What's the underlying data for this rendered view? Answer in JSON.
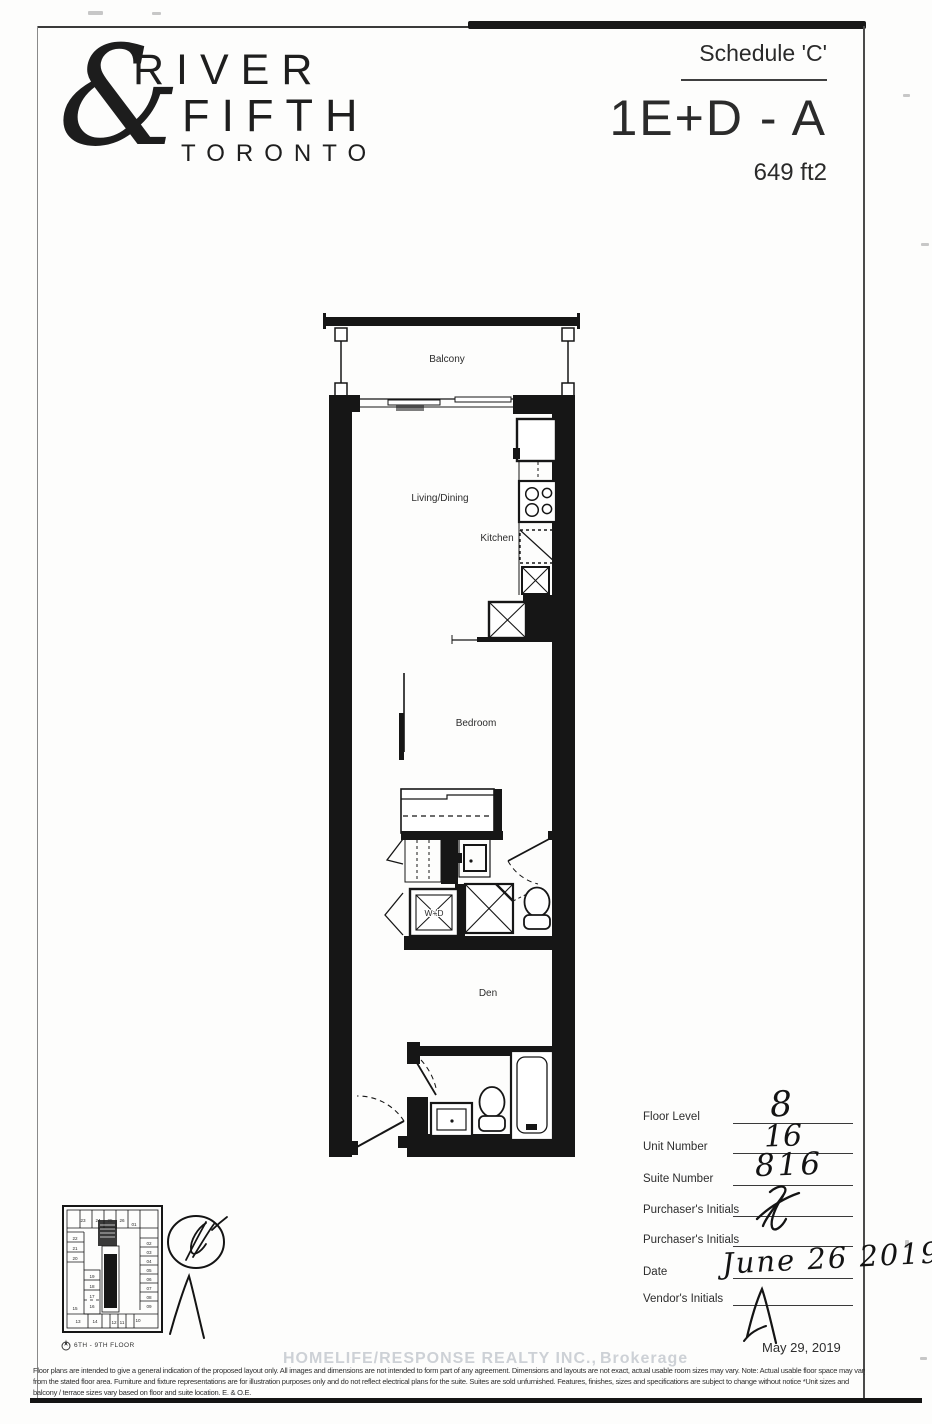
{
  "header": {
    "logo": {
      "ampersand": "&",
      "name_top": "RIVER",
      "name_bottom": "FIFTH",
      "city": "TORONTO"
    },
    "schedule_label": "Schedule 'C'",
    "model_code": "1E+D - A",
    "area": "649 ft2"
  },
  "plan": {
    "labels": {
      "balcony": "Balcony",
      "living_dining": "Living/Dining",
      "kitchen": "Kitchen",
      "bedroom": "Bedroom",
      "den": "Den",
      "washer_dryer": "W+D"
    }
  },
  "key_plan": {
    "caption": "6TH - 9TH FLOOR",
    "units": [
      "23",
      "24",
      "25",
      "26",
      "01",
      "02",
      "03",
      "04",
      "05",
      "06",
      "07",
      "08",
      "09",
      "22",
      "21",
      "20",
      "19",
      "18",
      "17",
      "16",
      "15",
      "14",
      "13",
      "12",
      "11",
      "10"
    ]
  },
  "form": {
    "rows": [
      {
        "label": "Floor Level",
        "value": "8"
      },
      {
        "label": "Unit Number",
        "value": "16"
      },
      {
        "label": "Suite Number",
        "value": "816"
      },
      {
        "label": "Purchaser's Initials",
        "value": ""
      },
      {
        "label": "Purchaser's Initials",
        "value": ""
      },
      {
        "label": "Date",
        "value": "June 26 2019"
      },
      {
        "label": "Vendor's Initials",
        "value": ""
      }
    ],
    "print_date": "May 29, 2019"
  },
  "watermark": {
    "part1": "HOMELIFE/RESPONSE REALTY INC.,",
    "part2": "Brokerage"
  },
  "disclaimer": {
    "line1": "Floor plans are intended to give a general indication of the proposed layout only. All images and dimensions are not intended to form part of any agreement. Dimensions and layouts are not exact, actual usable room sizes may vary. Note: Actual usable floor space may vary",
    "line2": "from the stated floor area. Furniture and fixture representations are for illustration purposes only and do not reflect electrical plans for the suite. Suites are sold unfurnished. Features, finishes, sizes and specifications are subject to change without notice *Unit sizes and",
    "line3": "balcony / terrace sizes vary based on floor and suite location. E. & O.E."
  }
}
